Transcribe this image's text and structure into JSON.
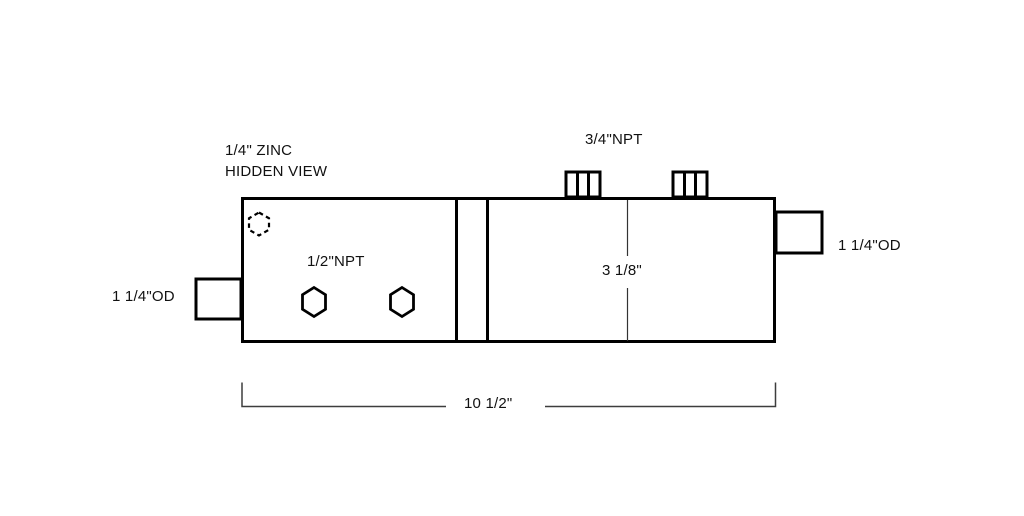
{
  "drawing": {
    "note": {
      "line1": "1/4\" ZINC",
      "line2": "HIDDEN VIEW"
    },
    "top_thread_label": "3/4\"NPT",
    "face_thread_label": "1/2\"NPT",
    "left_port_label": "1 1/4\"OD",
    "right_port_label": "1 1/4\"OD",
    "height_dimension": "3 1/8\"",
    "width_dimension": "10 1/2\"",
    "colors": {
      "outline": "#000000",
      "dimension_line": "#3d3d3d",
      "text": "#111111",
      "background": "#ffffff"
    }
  }
}
